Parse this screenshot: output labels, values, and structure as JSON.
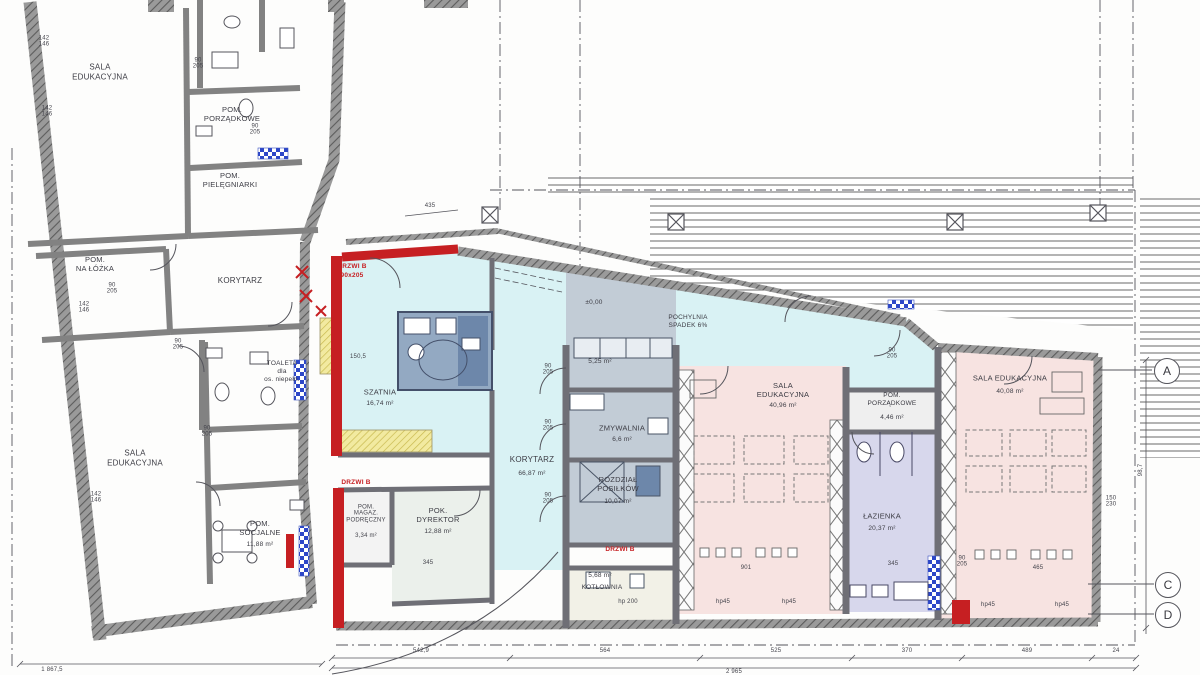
{
  "colors": {
    "corridor_cyan": "#d9f2f4",
    "room_pink": "#f7e3e1",
    "room_lavender": "#d7d7ec",
    "room_gray": "#c2ccd6",
    "sanitary_blue": "#93a9c2",
    "wall_gray": "#7a7a7a",
    "accent_red": "#c61f22",
    "stairs_yellow": "#efe79a",
    "glassblock_blue": "#2c46c8"
  },
  "left_wing": {
    "sala_edukacyjna_top": {
      "name": "SALA\nEDUKACYJNA"
    },
    "pom_porzadkowe": {
      "name": "POM.\nPORZĄDKOWE"
    },
    "pom_pielegniarki": {
      "name": "POM.\nPIELĘGNIARKI"
    },
    "pom_na_lozka": {
      "name": "POM.\nNA ŁÓŻKA"
    },
    "korytarz": {
      "name": "KORYTARZ"
    },
    "toaleta": {
      "name": "TOALETA\ndla\nos. niepełn."
    },
    "sala_edukacyjna_bottom": {
      "name": "SALA\nEDUKACYJNA"
    },
    "pom_socjalne": {
      "name": "POM.\nSOCJALNE",
      "area": "11,88 m²"
    }
  },
  "new_wing": {
    "szatnia": {
      "name": "SZATNIA",
      "area": "16,74 m²"
    },
    "pochylnia": {
      "name": "POCHYLNIA\nSPADEK 6%"
    },
    "level_mark": "±0,00",
    "room_525": {
      "area": "5,25 m²"
    },
    "zmywalnia": {
      "name": "ZMYWALNIA",
      "area": "6,6 m²"
    },
    "rozdzial_posilkow": {
      "name": "ROZDZIAŁ\nPOSIŁKÓW",
      "area": "10,07 m²"
    },
    "korytarz": {
      "name": "KORYTARZ",
      "area": "66,87 m²"
    },
    "sala_edukacyjna_mid": {
      "name": "SALA\nEDUKACYJNA",
      "area": "40,96 m²"
    },
    "pom_porzadkowe": {
      "name": "POM.\nPORZĄDKOWE",
      "area": "4,46 m²"
    },
    "lazienka": {
      "name": "ŁAZIENKA",
      "area": "20,37 m²"
    },
    "sala_edukacyjna_right": {
      "name": "SALA EDUKACYJNA",
      "area": "40,08 m²"
    },
    "pok_dyrektor": {
      "name": "POK.\nDYREKTOR",
      "area": "12,88 m²"
    },
    "pom_magazyn": {
      "name": "POM.\nMAGAZ.\nPODRĘCZNY",
      "area": "3,34 m²"
    },
    "kotlownia": {
      "name": "KOTŁOWNIA",
      "area": "5,68 m²",
      "note": "hp 200"
    }
  },
  "door_labels": {
    "drzwi_b": "DRZWI B",
    "size": "90x205"
  },
  "grid_markers": {
    "a": "A",
    "c": "C",
    "d": "D"
  },
  "dimensions": {
    "bottom_segments": [
      "542,9",
      "564",
      "525",
      "370",
      "489",
      "24"
    ],
    "bottom_total": "2 965",
    "left_total": "1 867,5",
    "door": "90\n205",
    "wall_142": "142\n146",
    "right_pair": "150\n230",
    "right_height": "98,7",
    "top_435": "435",
    "stair_150": "150,5",
    "dim_345": "345",
    "table_901": "901",
    "table_465": "465",
    "hp45": "hp45"
  }
}
